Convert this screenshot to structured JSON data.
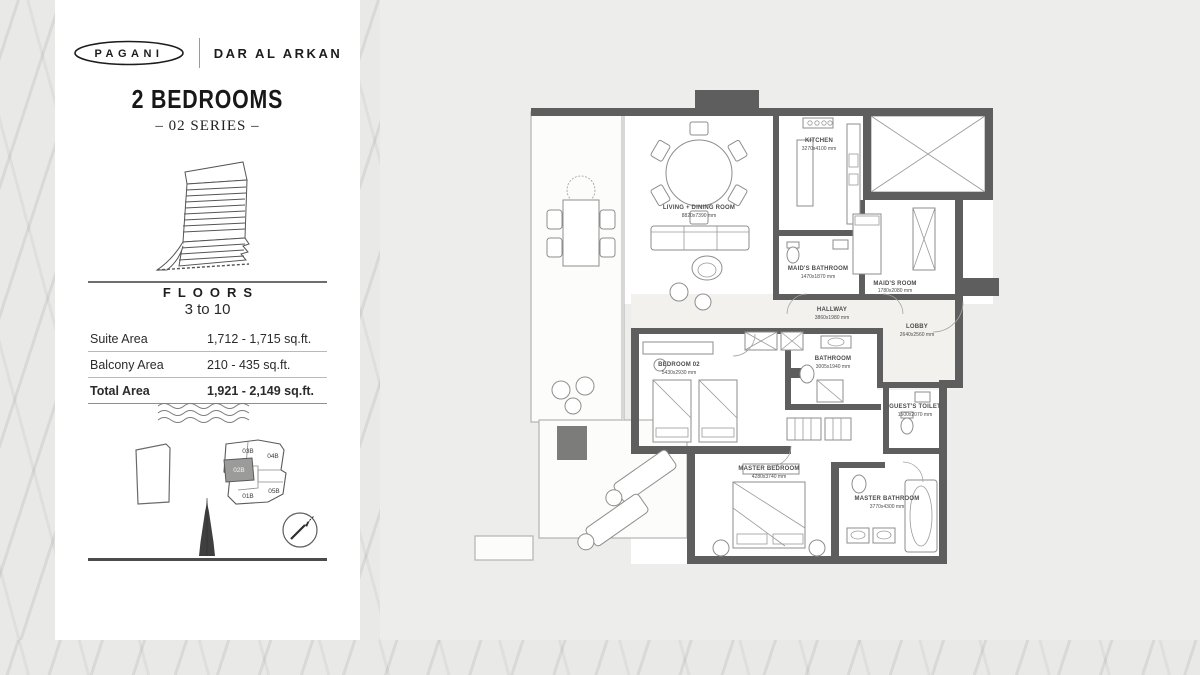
{
  "brand": {
    "pagani": "PAGANI",
    "dar_al_arkan": "DAR AL ARKAN"
  },
  "panel": {
    "title": "2 BEDROOMS",
    "series": "– 02 SERIES –",
    "floors": {
      "label": "FLOORS",
      "value": "3 to 10"
    },
    "area_table": {
      "rows": [
        {
          "label": "Suite Area",
          "value": "1,712 - 1,715 sq.ft."
        },
        {
          "label": "Balcony Area",
          "value": "210 - 435 sq.ft."
        },
        {
          "label": "Total Area",
          "value": "1,921 - 2,149 sq.ft."
        }
      ]
    },
    "keyplan": {
      "highlighted": "02B",
      "units": [
        {
          "id": "03B"
        },
        {
          "id": "04B"
        },
        {
          "id": "02B"
        },
        {
          "id": "01B"
        },
        {
          "id": "05B"
        }
      ]
    }
  },
  "floorplan": {
    "rooms": [
      {
        "name": "LIVING + DINING ROOM",
        "dims": "8820x7390 mm"
      },
      {
        "name": "KITCHEN",
        "dims": "3270x4100 mm"
      },
      {
        "name": "MAID'S BATHROOM",
        "dims": "1470x1870 mm"
      },
      {
        "name": "MAID'S ROOM",
        "dims": "1780x2080 mm"
      },
      {
        "name": "HALLWAY",
        "dims": "3860x1980 mm"
      },
      {
        "name": "LOBBY",
        "dims": "2640x2560 mm"
      },
      {
        "name": "BEDROOM 02",
        "dims": "5430x2930 mm"
      },
      {
        "name": "BATHROOM",
        "dims": "3005x1940 mm"
      },
      {
        "name": "GUEST'S TOILET",
        "dims": "1500x2070 mm"
      },
      {
        "name": "MASTER BEDROOM",
        "dims": "4280x3740 mm"
      },
      {
        "name": "MASTER BATHROOM",
        "dims": "3770x4300 mm"
      }
    ]
  },
  "colors": {
    "wall": "#5e5e5e",
    "card": "#ffffff",
    "background": "#ececea"
  }
}
